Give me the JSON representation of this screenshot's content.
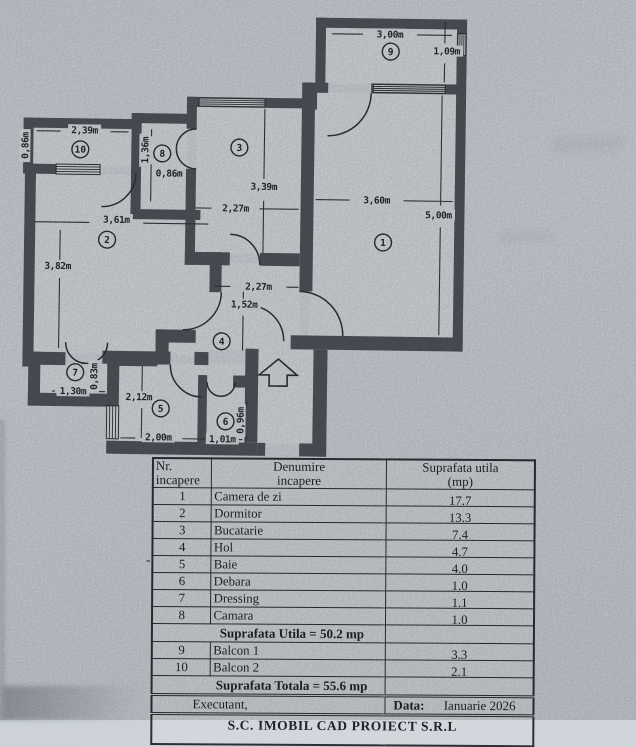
{
  "plan": {
    "rooms": [
      {
        "n": "1",
        "x": 386,
        "y": 238
      },
      {
        "n": "2",
        "x": 110,
        "y": 239
      },
      {
        "n": "3",
        "x": 241,
        "y": 145
      },
      {
        "n": "4",
        "x": 226,
        "y": 339
      },
      {
        "n": "5",
        "x": 166,
        "y": 407
      },
      {
        "n": "6",
        "x": 231,
        "y": 419
      },
      {
        "n": "7",
        "x": 80,
        "y": 372
      },
      {
        "n": "8",
        "x": 164,
        "y": 152
      },
      {
        "n": "9",
        "x": 391,
        "y": 47
      },
      {
        "n": "10",
        "x": 82,
        "y": 149
      }
    ],
    "dims": [
      {
        "t": "3,00m",
        "x": 390,
        "y": 33,
        "rot": false
      },
      {
        "t": "1,09m",
        "x": 447,
        "y": 49,
        "rot": false
      },
      {
        "t": "2,39m",
        "x": 86,
        "y": 133,
        "rot": false
      },
      {
        "t": "0,86m",
        "x": 30,
        "y": 146,
        "rot": true
      },
      {
        "t": "1,36m",
        "x": 150,
        "y": 149,
        "rot": true
      },
      {
        "t": "0,86m",
        "x": 171,
        "y": 175,
        "rot": false
      },
      {
        "t": "3,39m",
        "x": 266,
        "y": 187,
        "rot": false
      },
      {
        "t": "2,27m",
        "x": 238,
        "y": 209,
        "rot": false
      },
      {
        "t": "3,60m",
        "x": 379,
        "y": 199,
        "rot": false
      },
      {
        "t": "5,00m",
        "x": 441,
        "y": 213,
        "rot": false
      },
      {
        "t": "3,61m",
        "x": 119,
        "y": 222,
        "rot": false
      },
      {
        "t": "3,82m",
        "x": 61,
        "y": 269,
        "rot": false
      },
      {
        "t": "2,27m",
        "x": 262,
        "y": 287,
        "rot": false
      },
      {
        "t": "1,52m",
        "x": 248,
        "y": 305,
        "rot": false
      },
      {
        "t": "1,30m",
        "x": 78,
        "y": 394,
        "rot": false
      },
      {
        "t": "0,83m",
        "x": 102,
        "y": 376,
        "rot": true
      },
      {
        "t": "2,12m",
        "x": 144,
        "y": 399,
        "rot": false
      },
      {
        "t": "2,00m",
        "x": 164,
        "y": 439,
        "rot": false
      },
      {
        "t": "1,01m",
        "x": 228,
        "y": 440,
        "rot": false
      },
      {
        "t": "0,96m",
        "x": 249,
        "y": 418,
        "rot": true
      }
    ]
  },
  "table": {
    "headers": [
      {
        "line1": "Nr.",
        "line2": "incapere"
      },
      {
        "line1": "Denumire",
        "line2": "incapere"
      },
      {
        "line1": "Suprafata utila",
        "line2": "(mp)"
      }
    ],
    "rows": [
      {
        "nr": "1",
        "name": "Camera de zi",
        "area": "17.7"
      },
      {
        "nr": "2",
        "name": "Dormitor",
        "area": "13.3"
      },
      {
        "nr": "3",
        "name": "Bucatarie",
        "area": "7.4"
      },
      {
        "nr": "4",
        "name": "Hol",
        "area": "4.7"
      },
      {
        "nr": "5",
        "name": "Baie",
        "area": "4.0"
      },
      {
        "nr": "6",
        "name": "Debara",
        "area": "1.0"
      },
      {
        "nr": "7",
        "name": "Dressing",
        "area": "1.1"
      },
      {
        "nr": "8",
        "name": "Camara",
        "area": "1.0"
      },
      {
        "merged": "Suprafata Utila = 50.2 mp"
      },
      {
        "nr": "9",
        "name": "Balcon 1",
        "area": "3.3"
      },
      {
        "nr": "10",
        "name": "Balcon 2",
        "area": "2.1"
      },
      {
        "merged": "Suprafata Totala = 55.6 mp"
      }
    ],
    "footer": {
      "executant": "Executant,",
      "date_label": "Data:",
      "date_value": "Ianuarie 2026"
    },
    "company": "S.C. IMOBIL CAD PROIECT S.R.L"
  },
  "artifacts": {
    "stray_dash": "-"
  },
  "colors": {
    "wall": "#50555c",
    "floor": "#d7dbdf",
    "line": "#2e3237",
    "paper": "#cdd3d9"
  }
}
